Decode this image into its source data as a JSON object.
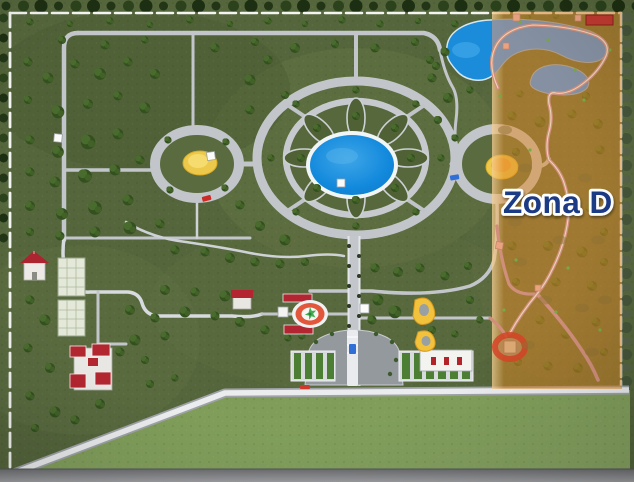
{
  "zone": {
    "label": "Zona D"
  },
  "colors": {
    "overlay_orange": "#E18A26",
    "label_navy": "#1D3B85",
    "label_outline": "#FFFFFF",
    "pond_blue": "#1289DC",
    "lake_blue": "#1B8CD9",
    "lake_slate": "#8493AA",
    "path_grey": "#C2C6CB",
    "zone_path_pink": "#D08F7C",
    "grass_green": "#55663C",
    "lawn_green": "#7E9A58",
    "tree_green": "#33501F",
    "flower_yellow": "#ECC94B",
    "helipad_red": "#E2573B",
    "roof_red": "#B22531",
    "sign_red": "#C13A30"
  },
  "features": [
    "perimeter-fence",
    "orchard-trees",
    "left-roundabout",
    "central-flower-garden",
    "central-pond",
    "right-roundabout",
    "ornamental-lake",
    "small-lake",
    "greenhouses",
    "red-roof-house",
    "farm-buildings",
    "helipad-fountain",
    "central-avenue",
    "plaza-staircase",
    "parking-rows",
    "service-building",
    "flower-beds",
    "red-sign",
    "red-ring-plaza",
    "zone-d-highlight"
  ]
}
